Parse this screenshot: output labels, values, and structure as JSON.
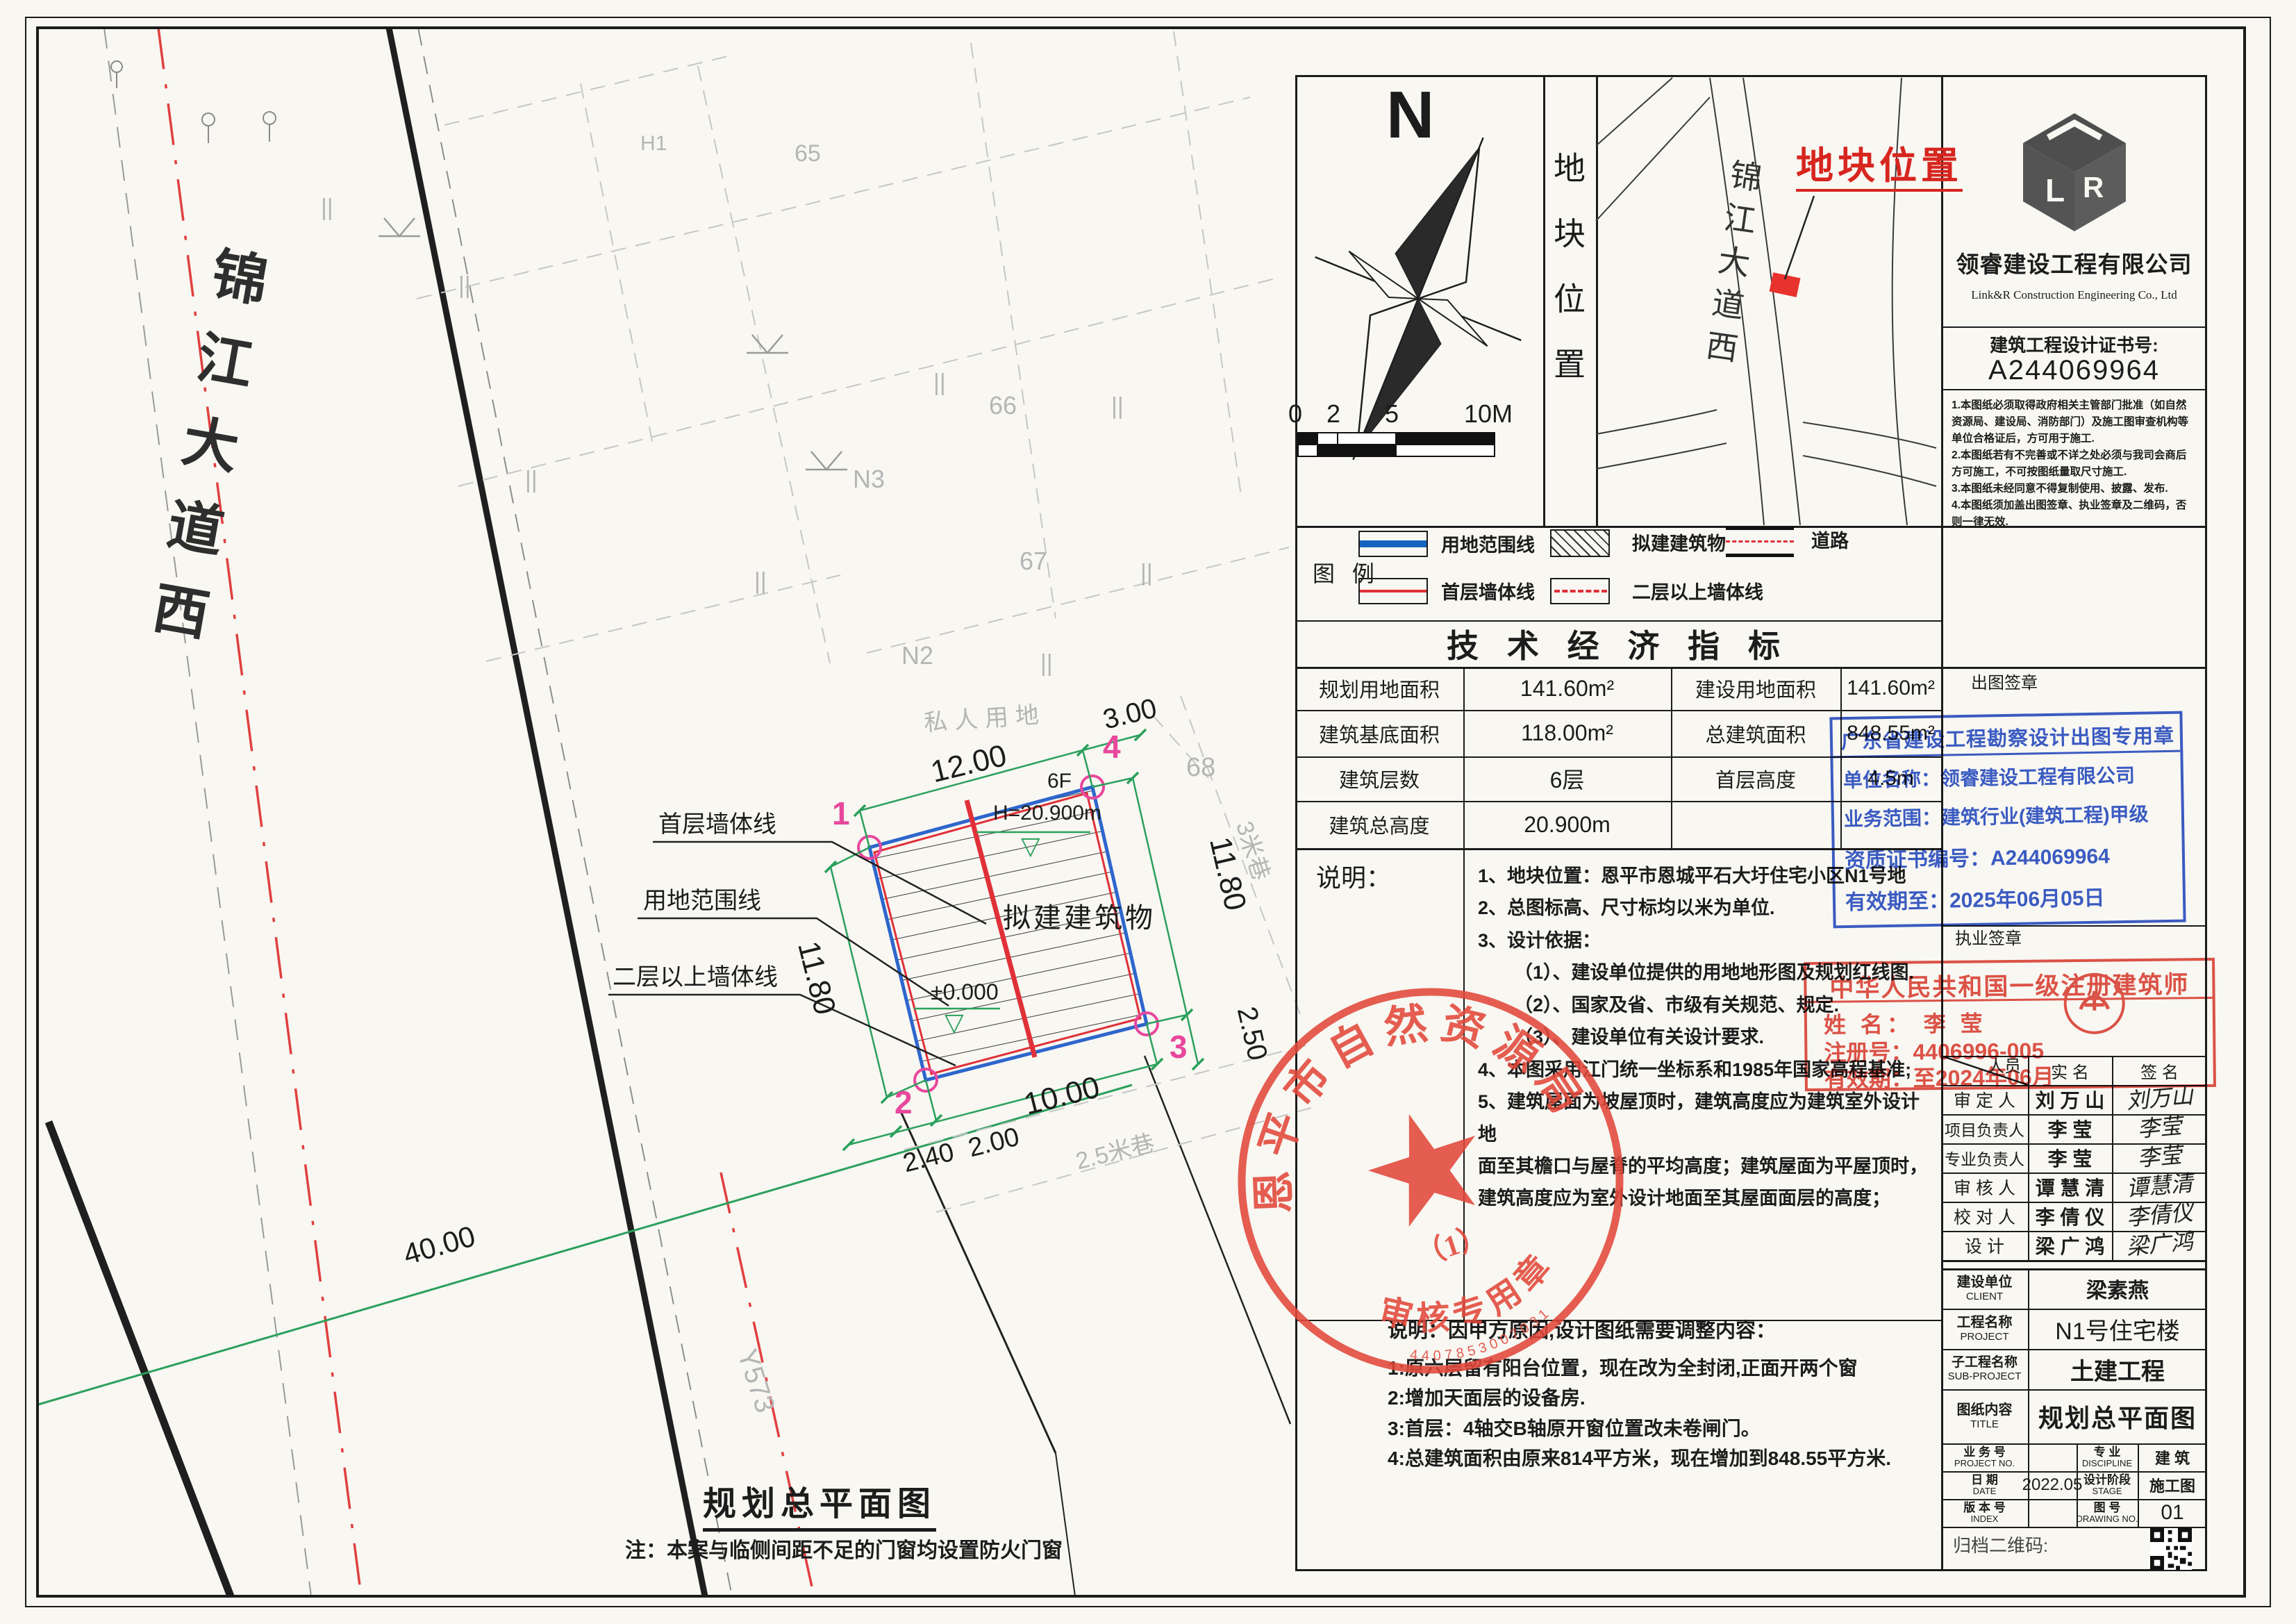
{
  "plan": {
    "road_name": "锦江大道西",
    "labels": {
      "private_land": "私人用地",
      "lane_3m": "3米巷",
      "lane_2_5m": "2.5米巷",
      "road_code": "Y573",
      "building": "拟建建筑物",
      "floors": "6F",
      "height": "H=20.900m",
      "level": "±0.000",
      "parcel_h1": "H1",
      "parcel_65": "65",
      "parcel_n3": "N3",
      "parcel_66": "66",
      "parcel_67": "67",
      "parcel_n2": "N2",
      "parcel_68": "68"
    },
    "leaders": [
      "首层墙体线",
      "用地范围线",
      "二层以上墙体线"
    ],
    "corners": [
      "1",
      "2",
      "3",
      "4"
    ],
    "dims": {
      "top": "12.00",
      "top_right": "3.00",
      "right": "11.80",
      "right2": "2.50",
      "bottom": "10.00",
      "bl1": "2.40",
      "bl2": "2.00",
      "left": "11.80",
      "survey": "40.00"
    },
    "title": "规划总平面图",
    "note": "注：本案与临侧间距不足的门窗均设置防火门窗"
  },
  "north": {
    "label": "N",
    "scale": [
      "0",
      "2",
      "5",
      "10M"
    ]
  },
  "strip_label": "地块位置",
  "map": {
    "road": "锦江大道西",
    "marker": "地块位置"
  },
  "company": {
    "name": "领睿建设工程有限公司",
    "name_en": "Link&R Construction Engineering Co., Ltd",
    "cert_label": "建筑工程设计证书号:",
    "cert_no": "A244069964",
    "notes": [
      "1.本图纸必须取得政府相关主管部门批准（如自然资源局、建设局、消防部门）及施工图审查机构等单位合格证后，方可用于施工.",
      "2.本图纸若有不完善或不详之处必须与我司会商后方可施工，不可按图纸量取尺寸施工.",
      "3.本图纸未经同意不得复制使用、披露、发布.",
      "4.本图纸须加盖出图签章、执业签章及二维码，否则一律无效."
    ]
  },
  "legend": {
    "title": "图 例",
    "items": [
      {
        "label": "用地范围线"
      },
      {
        "label": "拟建建筑物"
      },
      {
        "label": "道路"
      },
      {
        "label": "首层墙体线"
      },
      {
        "label": "二层以上墙体线"
      }
    ]
  },
  "indicators": {
    "title": "技 术 经 济 指 标",
    "rows": [
      {
        "l1": "规划用地面积",
        "v1": "141.60m²",
        "l2": "建设用地面积",
        "v2": "141.60m²"
      },
      {
        "l1": "建筑基底面积",
        "v1": "118.00m²",
        "l2": "总建筑面积",
        "v2": "848.55m²"
      },
      {
        "l1": "建筑层数",
        "v1": "6层",
        "l2": "首层高度",
        "v2": "4.5m"
      },
      {
        "l1": "建筑总高度",
        "v1": "20.900m",
        "l2": "",
        "v2": ""
      }
    ]
  },
  "notes": {
    "label": "说明：",
    "lines": [
      "1、地块位置：恩平市恩城平石大圩住宅小区N1号地",
      "2、总图标高、尺寸标均以米为单位.",
      "3、设计依据：",
      "（1）、建设单位提供的用地地形图及规划红线图.",
      "（2）、国家及省、市级有关规范、规定.",
      "（3）、建设单位有关设计要求.",
      "4、本图采用江门统一坐标系和1985年国家高程基准;",
      "5、建筑屋面为坡屋顶时，建筑高度应为建筑室外设计地",
      "面至其檐口与屋脊的平均高度；建筑屋面为平屋顶时，",
      "建筑高度应为室外设计地面至其屋面面层的高度；"
    ]
  },
  "adjust": {
    "title": "说明：因甲方原因,设计图纸需要调整内容：",
    "lines": [
      "1:原六层留有阳台位置，现在改为全封闭,正面开两个窗",
      "2:增加天面层的设备房.",
      "3:首层：4轴交B轴原开窗位置改未卷闸门。",
      "4:总建筑面积由原来814平方米，现在增加到848.55平方米."
    ]
  },
  "stamps": {
    "chutu_label": "出图签章",
    "zhiye_label": "执业签章",
    "blue": {
      "title": "广东省建设工程勘察设计出图专用章",
      "line1": "单位名称：领睿建设工程有限公司",
      "line2": "业务范围：建筑行业(建筑工程)甲级",
      "line3": "资质证书编号：A244069964",
      "line4": "有效期至：2025年06月05日",
      "color": "#2b50c8"
    },
    "red": {
      "title": "中华人民共和国一级注册建筑师",
      "name_line": "姓  名：  李  莹",
      "reg_line": "注册号：4406996-005",
      "valid_line": "有效期：至2024年06月",
      "color": "#e0453a"
    },
    "seal": {
      "arc_top": "恩平市自然资源局",
      "arc_bottom": "审核专用章",
      "sub": "（1）",
      "serial": "4407853007031",
      "color": "#e2483a"
    }
  },
  "sign_table": {
    "corner": "人员",
    "col_name": "实  名",
    "col_sig": "签  名",
    "rows": [
      {
        "role": "审 定 人",
        "name": "刘 万 山",
        "sig": "刘万山"
      },
      {
        "role": "项目负责人",
        "name": "李   莹",
        "sig": "李莹"
      },
      {
        "role": "专业负责人",
        "name": "李   莹",
        "sig": "李莹"
      },
      {
        "role": "审 核 人",
        "name": "谭 慧 清",
        "sig": "谭慧清"
      },
      {
        "role": "校 对 人",
        "name": "李 倩 仪",
        "sig": "李倩仪"
      },
      {
        "role": "设  计",
        "name": "梁 广 鸿",
        "sig": "梁广鸿"
      }
    ]
  },
  "title_block": {
    "client_label": "建设单位",
    "client_en": "CLIENT",
    "client": "梁素燕",
    "project_label": "工程名称",
    "project_en": "PROJECT",
    "project": "N1号住宅楼",
    "sub_label": "子工程名称",
    "sub_en": "SUB-PROJECT",
    "sub": "土建工程",
    "content_label": "图纸内容",
    "content_en": "TITLE",
    "content": "规划总平面图",
    "no_label": "业 务 号",
    "no_en": "PROJECT NO.",
    "no": "",
    "discipline_label": "专  业",
    "discipline_en": "DISCIPLINE",
    "discipline": "建  筑",
    "date_label": "日  期",
    "date_en": "DATE",
    "date": "2022.05",
    "stage_label": "设计阶段",
    "stage_en": "STAGE",
    "stage": "施工图",
    "index_label": "版 本 号",
    "index_en": "INDEX",
    "index": "",
    "dwg_label": "图  号",
    "dwg_en": "DRAWING NO.",
    "dwg": "01",
    "qr_label": "归档二维码:"
  }
}
